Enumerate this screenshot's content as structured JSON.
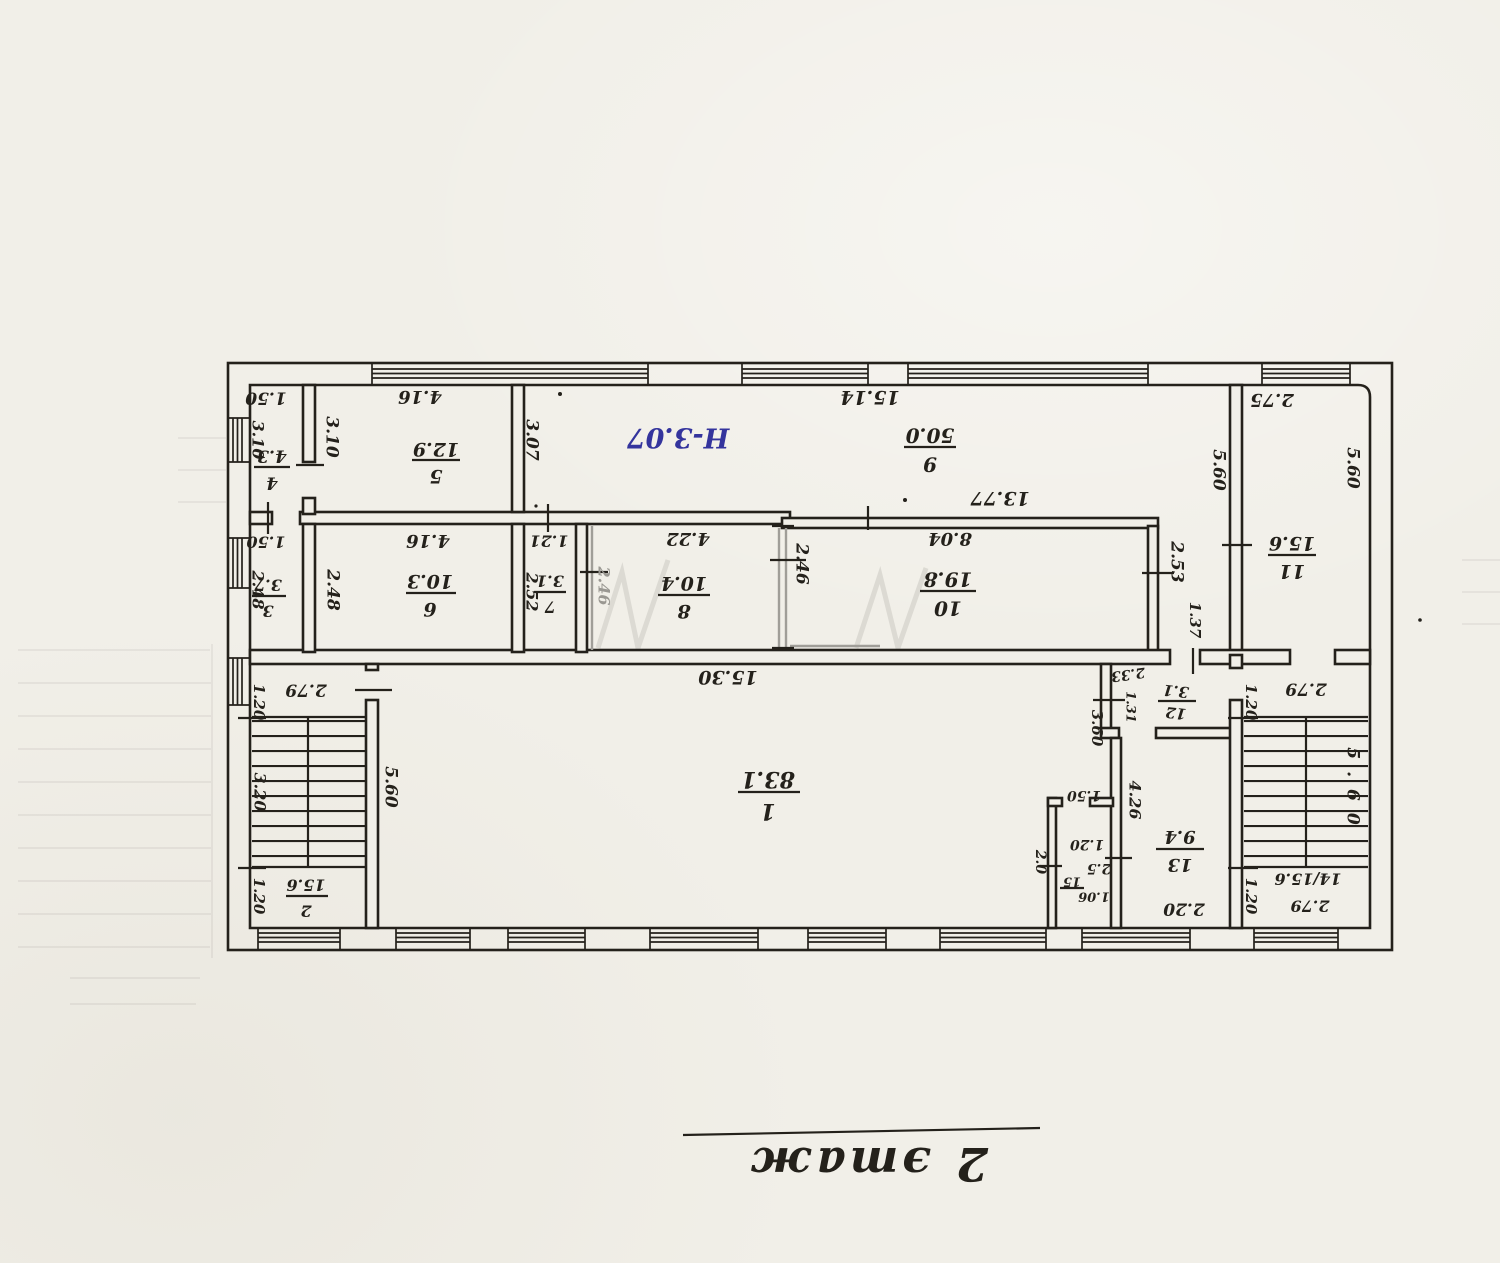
{
  "page": {
    "background": "#f1efe8",
    "ink": "#24211b",
    "pencil": "#a09e98",
    "blue_ink": "#34349d"
  },
  "plan": {
    "caption": "2 этаж",
    "height_note": "Н-3.07",
    "rooms": {
      "r1": {
        "num": "1",
        "area": "83.1"
      },
      "r2": {
        "num": "2",
        "area": "15.6"
      },
      "r3": {
        "num": "3",
        "area": "3.7"
      },
      "r4": {
        "num": "4",
        "area": "4.3"
      },
      "r5": {
        "num": "5",
        "area": "12.9"
      },
      "r6": {
        "num": "6",
        "area": "10.3"
      },
      "r7": {
        "num": "7",
        "area": "3.1"
      },
      "r8": {
        "num": "8",
        "area": "10.4"
      },
      "r9": {
        "num": "9",
        "area": "50.0"
      },
      "r10": {
        "num": "10",
        "area": "19.8"
      },
      "r11": {
        "num": "11",
        "area": "15.6"
      },
      "r12": {
        "num": "12",
        "area": "3.1"
      },
      "r13": {
        "num": "13",
        "area": "9.4"
      },
      "r14": {
        "combined": "14/15.6"
      },
      "r15": {
        "num": "15",
        "area": "2.5",
        "extra": "1.06"
      }
    },
    "dims": {
      "r4_w": "1.50",
      "r4_h": "3.10",
      "r5_h": "3.10",
      "r5_w": "4.16",
      "r9_w": "15.14",
      "r11_w": "2.75",
      "r9_h": "3.07",
      "r9_b": "13.77",
      "arm_h": "5.60",
      "r11_h": "5.60",
      "arm_w": "2.53",
      "arm_b": "1.37",
      "r3_w": "1.50",
      "r3_h": "2.48",
      "r6_h": "2.48",
      "r6_w": "4.16",
      "r7_w": "1.21",
      "r7_h": "2.52",
      "gray_w": "2.46",
      "r8_w": "4.22",
      "r10_l": "2.46",
      "r10_w": "8.04",
      "r1_w": "15.30",
      "stairL_h": "5.60",
      "landL_w": "2.79",
      "landL_d": "1.20",
      "stairL_run": "3.20",
      "r2_d": "1.20",
      "r12_w": "2.33",
      "r12_h": "1.31",
      "r12_out": "3.60",
      "r13_h": "4.26",
      "r13_w": "2.20",
      "r15_top": "1.50",
      "r15_door": "1.20",
      "r15_l": "2.0",
      "landR_w": "2.79",
      "landR_d": "1.20",
      "stairR_h": "5.60",
      "r14_d": "1.20",
      "r14_b": "2.79"
    }
  }
}
